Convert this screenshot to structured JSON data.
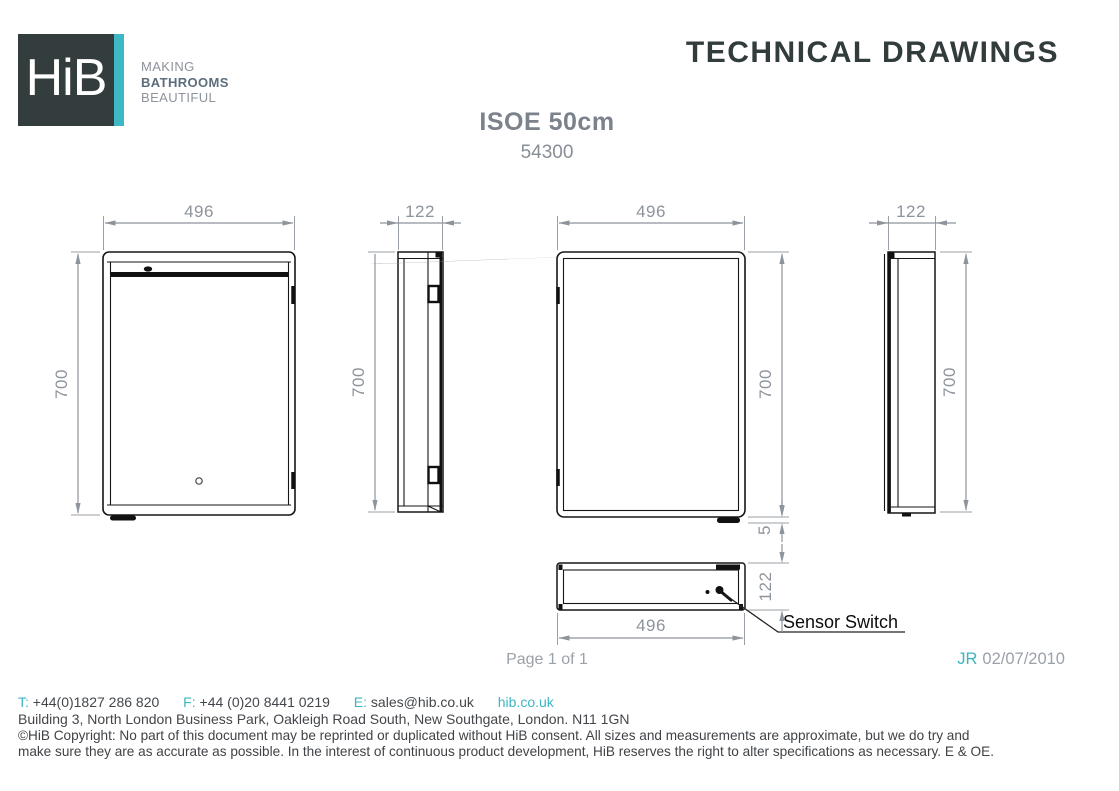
{
  "header": {
    "logo_text": "HiB",
    "tagline": [
      "MAKING",
      "BATHROOMS",
      "BEAUTIFUL"
    ],
    "doc_title": "TECHNICAL DRAWINGS"
  },
  "product": {
    "name": "ISOE 50cm",
    "code": "54300"
  },
  "drawings": {
    "front_view": {
      "width": "496",
      "height": "700"
    },
    "side_view_left": {
      "width": "122",
      "height": "700"
    },
    "rear_view": {
      "width": "496",
      "height": "700",
      "foot_height": "5"
    },
    "side_view_right": {
      "width": "122",
      "height": "700"
    },
    "bottom_view": {
      "width": "496",
      "depth": "122",
      "annotation": "Sensor Switch"
    }
  },
  "meta": {
    "page": "Page 1 of 1",
    "author_initials": "JR",
    "date": "02/07/2010"
  },
  "contact": {
    "phone_label": "T:",
    "phone": "+44(0)1827 286 820",
    "fax_label": "F:",
    "fax": "+44 (0)20 8441 0219",
    "email_label": "E:",
    "email": "sales@hib.co.uk",
    "website": "hib.co.uk",
    "address": "Building 3, North London Business Park, Oakleigh Road South, New Southgate, London. N11 1GN"
  },
  "copyright": [
    "©HiB Copyright: No part of this document may be reprinted or duplicated without HiB consent. All sizes and measurements are approximate, but we do try and",
    "make sure they are as accurate as possible. In the interest of continuous product development, HiB reserves the right to alter specifications as necessary. E & OE."
  ],
  "colors": {
    "teal": "#3db6c3",
    "charcoal": "#323c3c",
    "dim_gray": "#8e949c"
  }
}
